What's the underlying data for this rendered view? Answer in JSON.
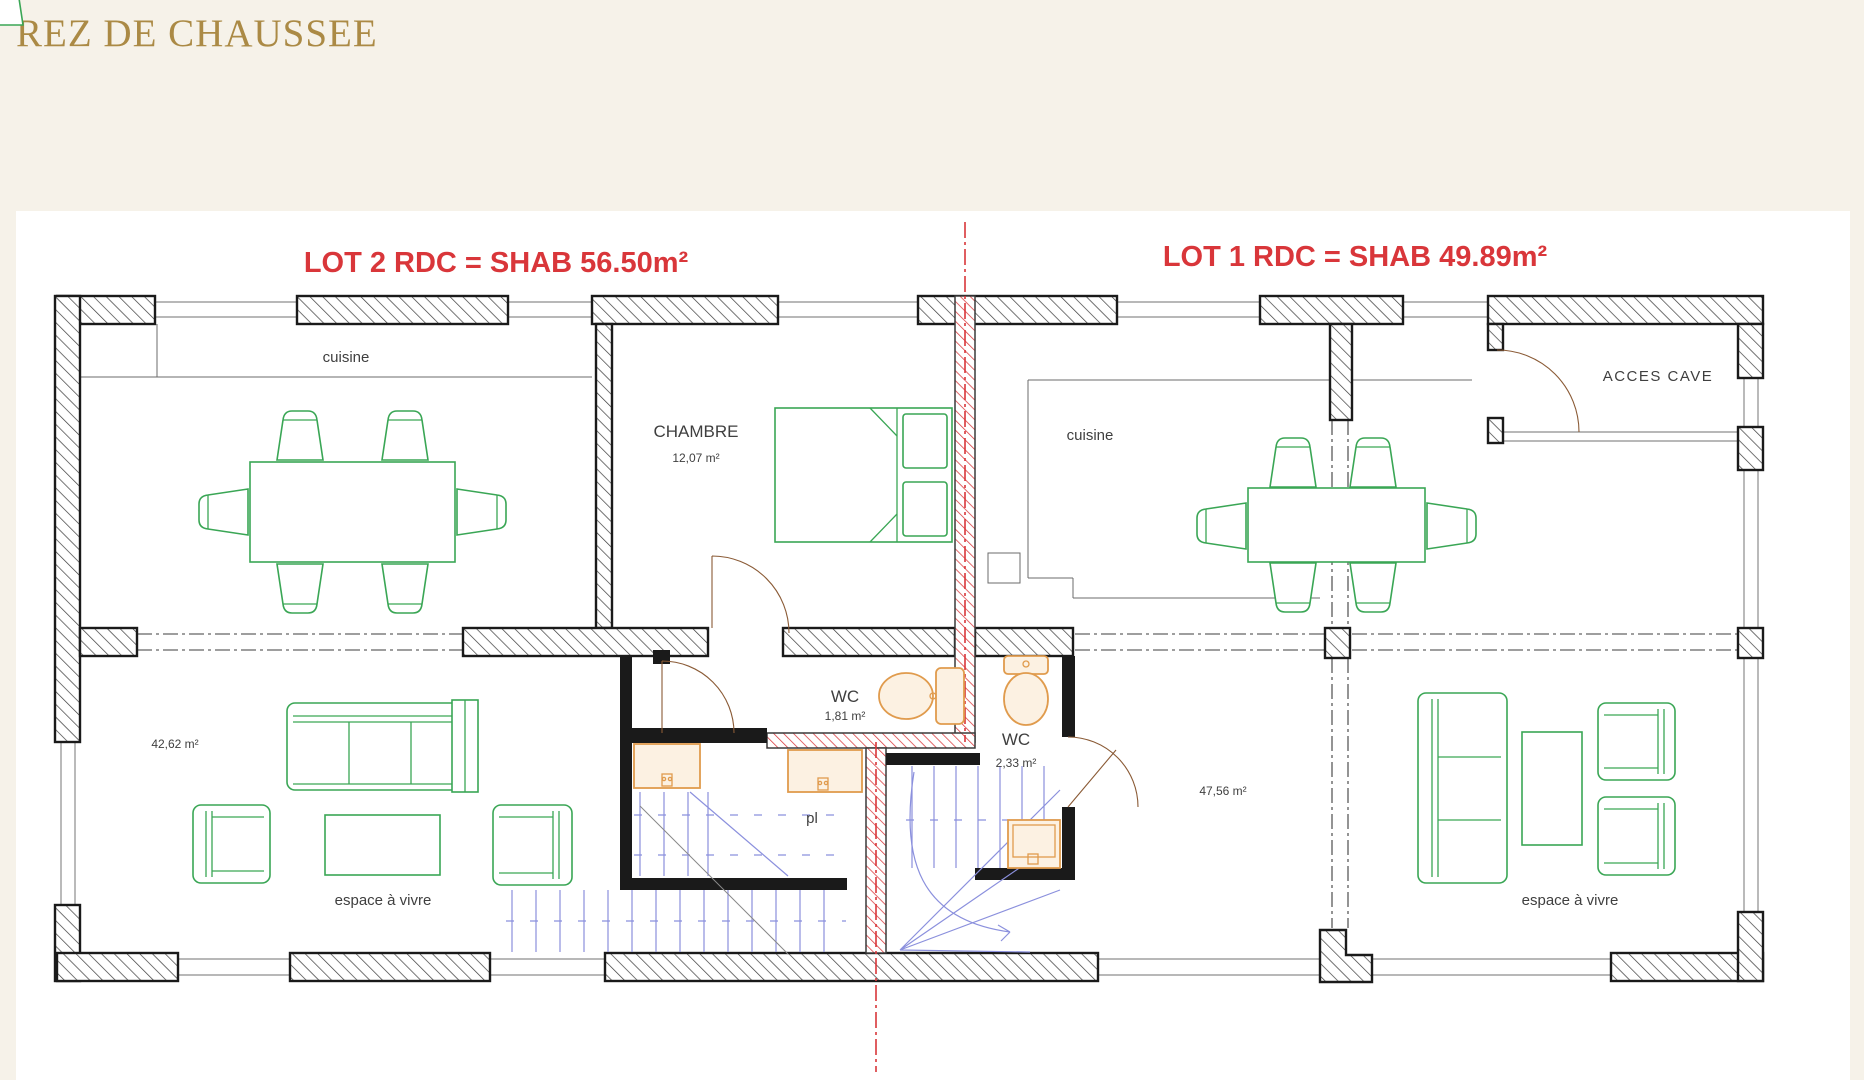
{
  "page": {
    "title": "REZ DE CHAUSSEE",
    "background": "#f6f2e9",
    "panel_background": "#ffffff"
  },
  "plan": {
    "lots": [
      {
        "name": "lot-2",
        "label": "LOT 2 RDC = SHAB 56.50m²"
      },
      {
        "name": "lot-1",
        "label": "LOT 1 RDC = SHAB 49.89m²"
      }
    ],
    "rooms": {
      "lot2_cuisine": {
        "label": "cuisine"
      },
      "chambre": {
        "label": "CHAMBRE",
        "area": "12,07 m²"
      },
      "wc1": {
        "label": "WC",
        "area": "1,81 m²"
      },
      "wc2": {
        "label": "WC",
        "area": "2,33 m²"
      },
      "placard": {
        "label": "pl"
      },
      "lot2_living": {
        "label": "espace à vivre",
        "area": "42,62 m²"
      },
      "lot1_cuisine": {
        "label": "cuisine"
      },
      "lot1_living": {
        "label": "espace à vivre",
        "area": "47,56 m²"
      },
      "acces_cave": {
        "label": "ACCES CAVE"
      }
    },
    "colors": {
      "lot_label": "#d9363a",
      "walls": "#1a1a1a",
      "party_line": "#d9363a",
      "furniture": "#3aa655",
      "fixtures": "#e09b4d",
      "stairs": "#8b90dd",
      "title": "#ab8a45",
      "room_text": "#3f3f3f"
    }
  }
}
